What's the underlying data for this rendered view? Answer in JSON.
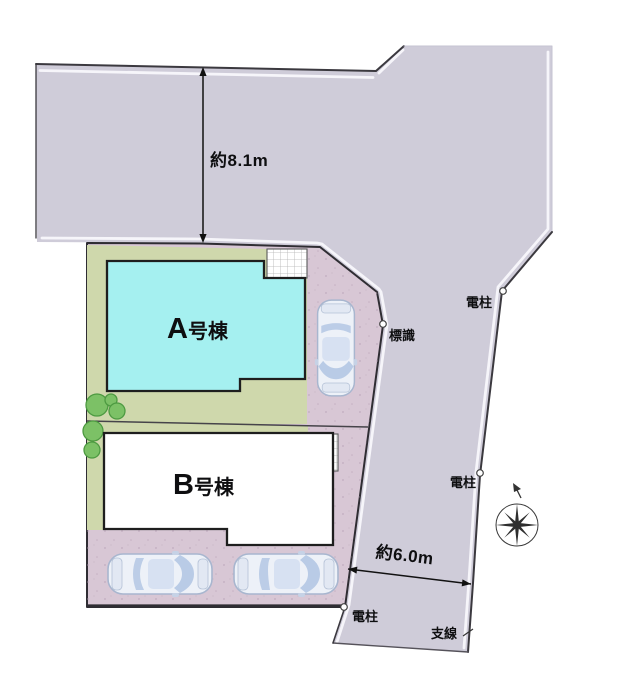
{
  "plan": {
    "buildings": [
      {
        "letter": "A",
        "suffix": "号棟"
      },
      {
        "letter": "B",
        "suffix": "号棟"
      }
    ],
    "dimensions": {
      "top_road_width": "約8.1m",
      "side_road_width": "約6.0m"
    },
    "labels": {
      "pole_top": "電柱",
      "pole_mid": "電柱",
      "pole_bottom": "電柱",
      "sign": "標識",
      "guy_wire": "支線"
    },
    "colors": {
      "road": "#cfccd9",
      "lot": "#d8c7d5",
      "green": "#cfd8ac",
      "building_a": "#a5f0f0",
      "building_b": "#ffffff",
      "tree": "#7cc166"
    }
  }
}
